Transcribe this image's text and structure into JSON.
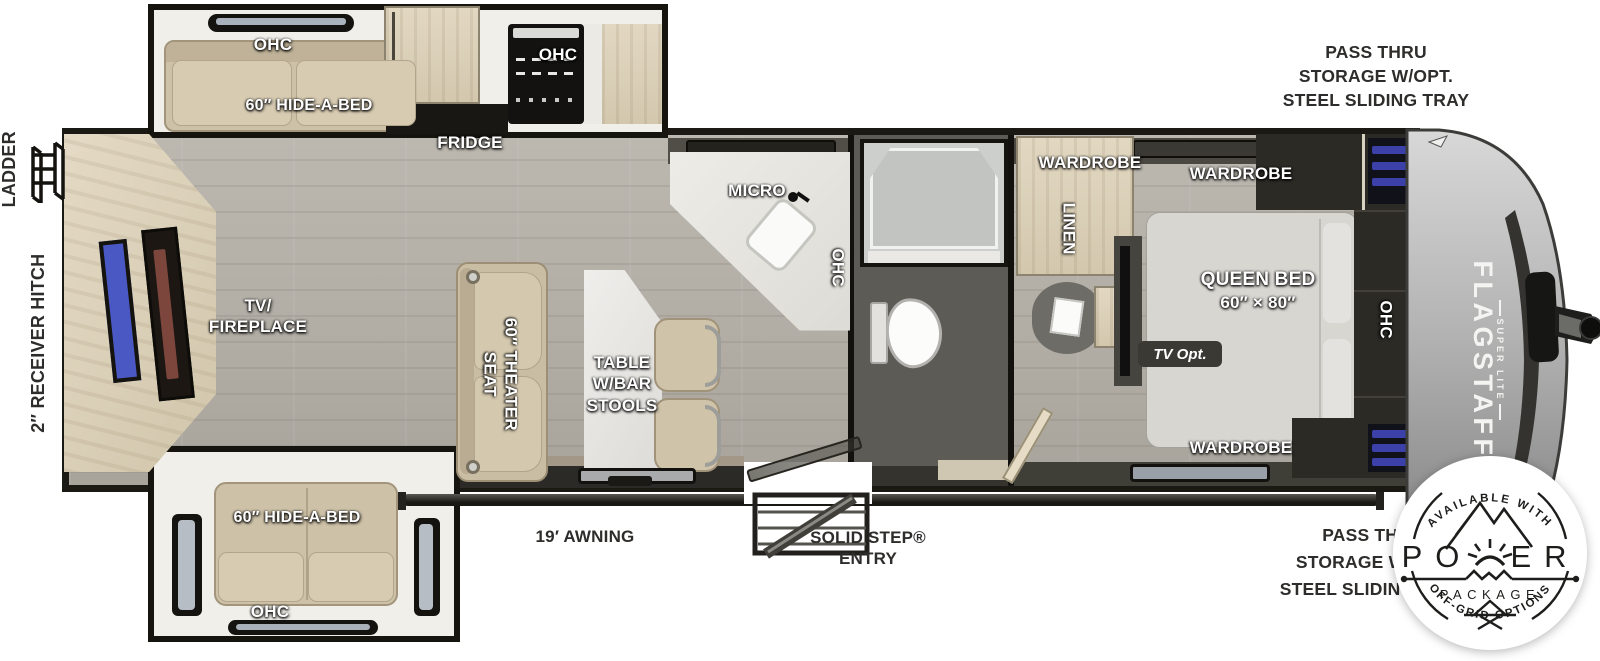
{
  "palette": {
    "wall": "#1a1914",
    "floor": "#b3afa7",
    "bath_floor": "#5c5b55",
    "cabinet": "#dcd2bb",
    "sofa": "#cdc1a8",
    "bed": "#d8d6d1",
    "tv_blue": "#4a58c4",
    "storage_blue": "#3b41a8",
    "cap_silver": "#aFAFaf",
    "label_white": "#ffffff",
    "label_dark": "#2e2d2b"
  },
  "exterior": {
    "pass_thru_top": {
      "line1": "PASS THRU",
      "line2": "STORAGE W/OPT.",
      "line3": "STEEL SLIDING TRAY"
    },
    "pass_thru_bottom": {
      "line1": "PASS THRU",
      "line2": "STORAGE W/OPT.",
      "line3": "STEEL SLIDING TRAY"
    },
    "ladder": "LADDER",
    "receiver_hitch": "2″ RECEIVER HITCH",
    "awning": "19′ AWNING",
    "entry": {
      "line1": "SOLID STEP®",
      "line2": "ENTRY"
    }
  },
  "rooms": {
    "top_slide": {
      "ohc": "OHC",
      "hide_a_bed": "60″ HIDE-A-BED"
    },
    "kitchen": {
      "fridge": "FRIDGE",
      "ohc_range": "OHC",
      "micro": "MICRO",
      "ohc_counter": "OHC"
    },
    "living": {
      "tv_fireplace_line1": "TV/",
      "tv_fireplace_line2": "FIREPLACE",
      "theater_line1": "60″ THEATER",
      "theater_line2": "SEAT",
      "table_line1": "TABLE",
      "table_line2": "W/BAR",
      "table_line3": "STOOLS"
    },
    "bottom_slide": {
      "hide_a_bed": "60″ HIDE-A-BED",
      "ohc": "OHC"
    },
    "bath": {
      "wardrobe": "WARDROBE",
      "linen": "LINEN"
    },
    "bedroom": {
      "wardrobe_top": "WARDROBE",
      "queen_bed_line1": "QUEEN BED",
      "queen_bed_line2": "60″ × 80″",
      "tv_opt": "TV Opt.",
      "wardrobe_bottom": "WARDROBE",
      "ohc": "OHC"
    }
  },
  "brand": {
    "name": "FLAGSTAFF",
    "sub": "SUPER LITE"
  },
  "badge": {
    "top_arc": "AVAILABLE WITH",
    "power_prefix": "PO",
    "power_suffix": "ER",
    "package": "PACKAGE",
    "bottom_arc": "OFF-GRID OPTIONS"
  }
}
